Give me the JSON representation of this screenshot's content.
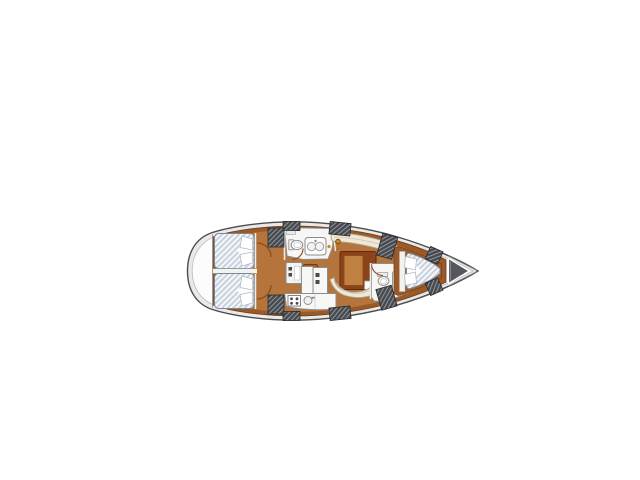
{
  "background": "#ffffff",
  "colors": {
    "hull_stroke": "#4c4c4c",
    "deck_rim": "#e9e9e9",
    "deck_inner": "#fcfcfc",
    "deck_edge_line": "#bdbdbd",
    "wood_trim": "#9a5a28",
    "wood_trim_stroke": "#6e3c14",
    "wood_floor": "#b5743c",
    "table_dark": "#8a4418",
    "table_dark_stroke": "#5e2c0c",
    "table_leaf": "#c08040",
    "steps_wood": "#a35d28",
    "upholstery": "#efe8d4",
    "upholstery_stroke": "#a8a190",
    "upholstery_seam": "#c9c2ae",
    "room_white": "#f6f6f5",
    "counter_white": "#f7f7f6",
    "fixture_white": "#ffffff",
    "fixture_stroke": "#8c8c8c",
    "mattress_base": "#ccd5df",
    "mattress_stripe": "#ffffff",
    "mattress_stroke": "#7a8796",
    "pillow_white": "#fdfdfd",
    "pillow_stroke": "#aab4c0",
    "hatch_base": "#46494e",
    "hatch_line": "#9aa0a6",
    "hatch_stroke": "#26282b",
    "anchor_locker": "#54575c",
    "door_arc": "#8a4a1e",
    "appliance_dark": "#4a4a4a",
    "brass_fitting": "#c8882a",
    "bulkhead_white": "#f2f2f0"
  }
}
